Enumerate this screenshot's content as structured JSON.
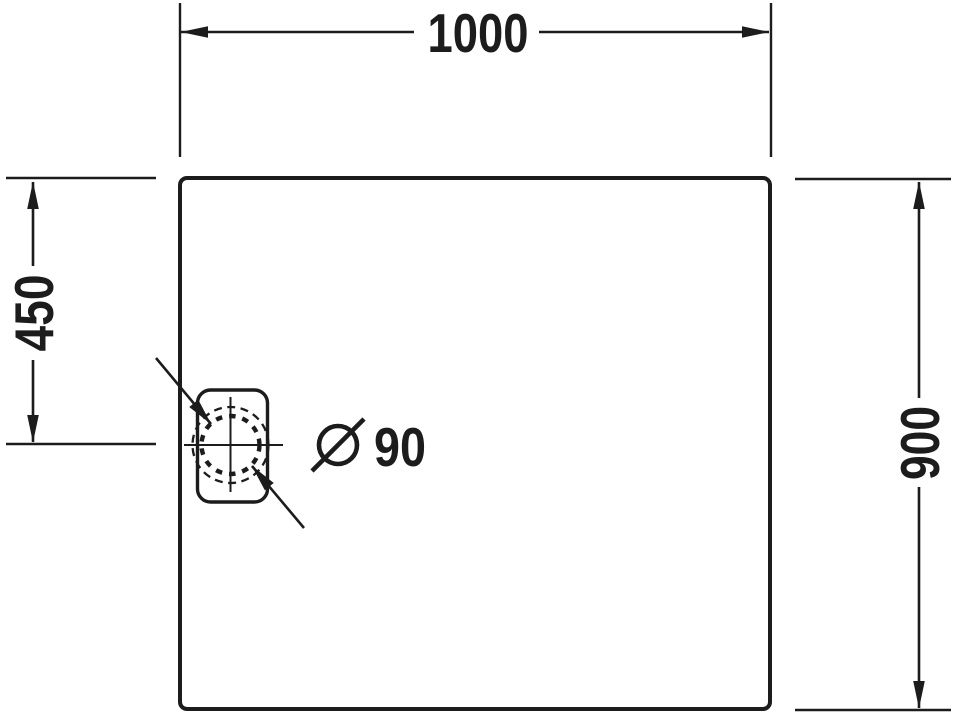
{
  "drawing": {
    "kind": "technical-dimension-drawing",
    "view": "shower-tray-top-view",
    "units": "mm",
    "colors": {
      "background": "#ffffff",
      "line": "#1c1c1c"
    },
    "dimensions": {
      "overall_width": {
        "value": "1000"
      },
      "overall_depth": {
        "value": "900"
      },
      "drain_center_from_top": {
        "value": "450"
      },
      "drain_diameter": {
        "symbol": "Ø",
        "value": "90",
        "label": "Ø 90"
      }
    }
  }
}
